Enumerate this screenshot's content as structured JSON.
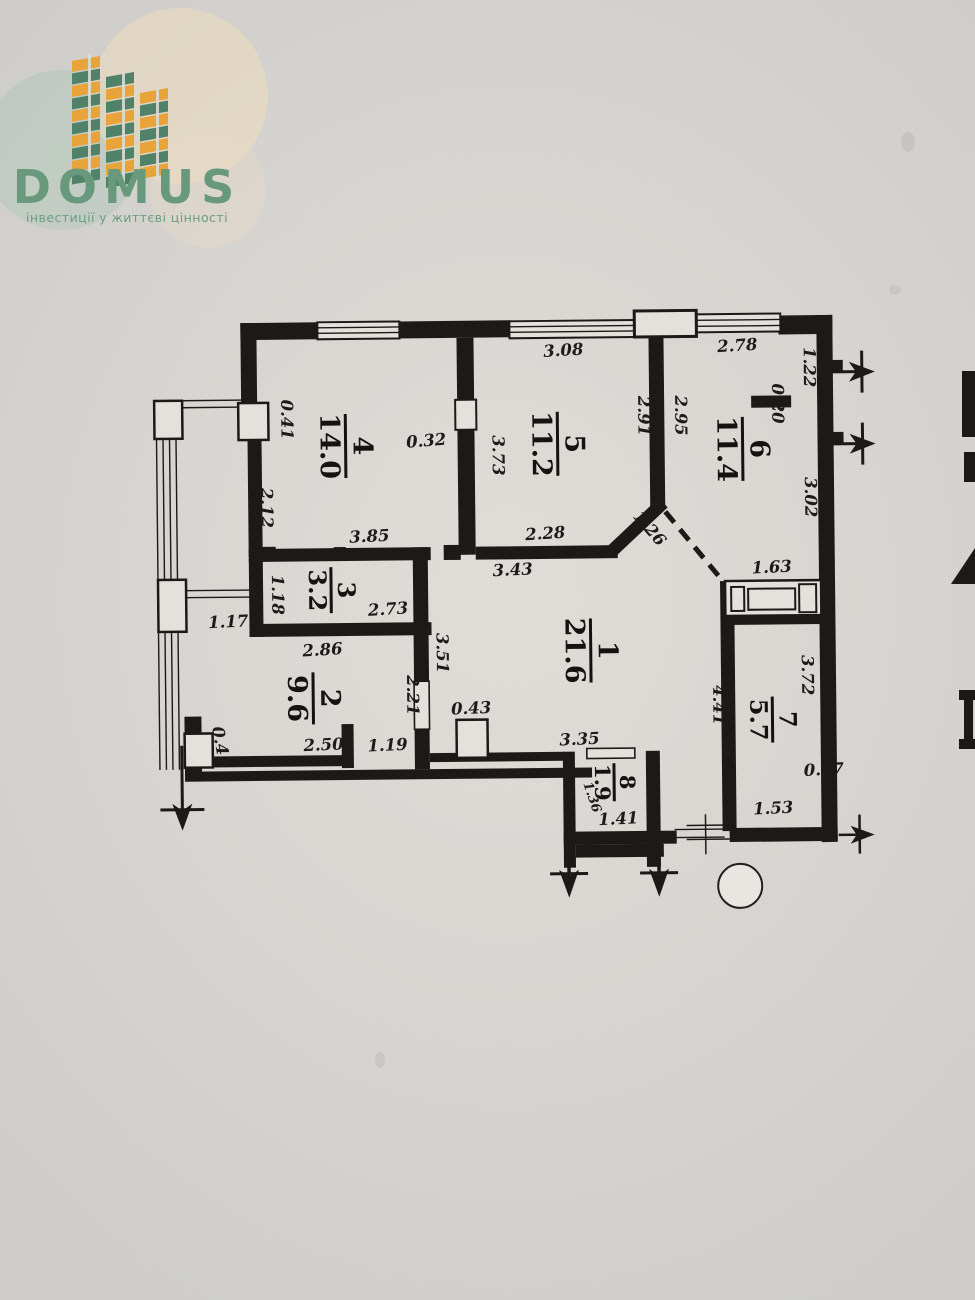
{
  "logo": {
    "name": "DOMUS",
    "tagline": "інвестиції у життєві цінності",
    "brand_green": "#68997c",
    "brand_orange": "#e8a33b",
    "block_green": "#4f8268"
  },
  "plan": {
    "rooms": [
      {
        "number": "1",
        "area": "21.6"
      },
      {
        "number": "2",
        "area": "9.6"
      },
      {
        "number": "3",
        "area": "3.2"
      },
      {
        "number": "4",
        "area": "14.0"
      },
      {
        "number": "5",
        "area": "11.2"
      },
      {
        "number": "6",
        "area": "11.4"
      },
      {
        "number": "7",
        "area": "5.7"
      },
      {
        "number": "8",
        "area": "1.9"
      }
    ],
    "dims": {
      "w5_top": "3.08",
      "w6_top": "2.78",
      "r6_niche_h": "1.22",
      "r6_niche_d": "0.20",
      "r6_right": "3.02",
      "r5_right": "2.95",
      "r5_left": "2.91",
      "r45_wall": "3.73",
      "r4_door": "0.32",
      "r4_balc": "0.41",
      "r4_left": "2.12",
      "r4_bottom": "3.85",
      "r5_bottom": "2.28",
      "r1_top": "3.43",
      "diag": "1.26",
      "closet": "1.63",
      "hall_pass": "1.17",
      "r3_left": "1.18",
      "r3_inner": "2.73",
      "r3_outer": "2.86",
      "corridor": "3.51",
      "r2_right": "2.21",
      "r1_right": "4.41",
      "r7_left": "3.72",
      "r2_bottom": "2.50",
      "r2_door": "1.19",
      "r2_pier": "0.41",
      "col": "0.43",
      "r1_bottom": "3.35",
      "r8_door": "0.37",
      "r8_bottom": "1.41",
      "r8_diag": "1.36",
      "r7_bottom": "1.53"
    }
  }
}
